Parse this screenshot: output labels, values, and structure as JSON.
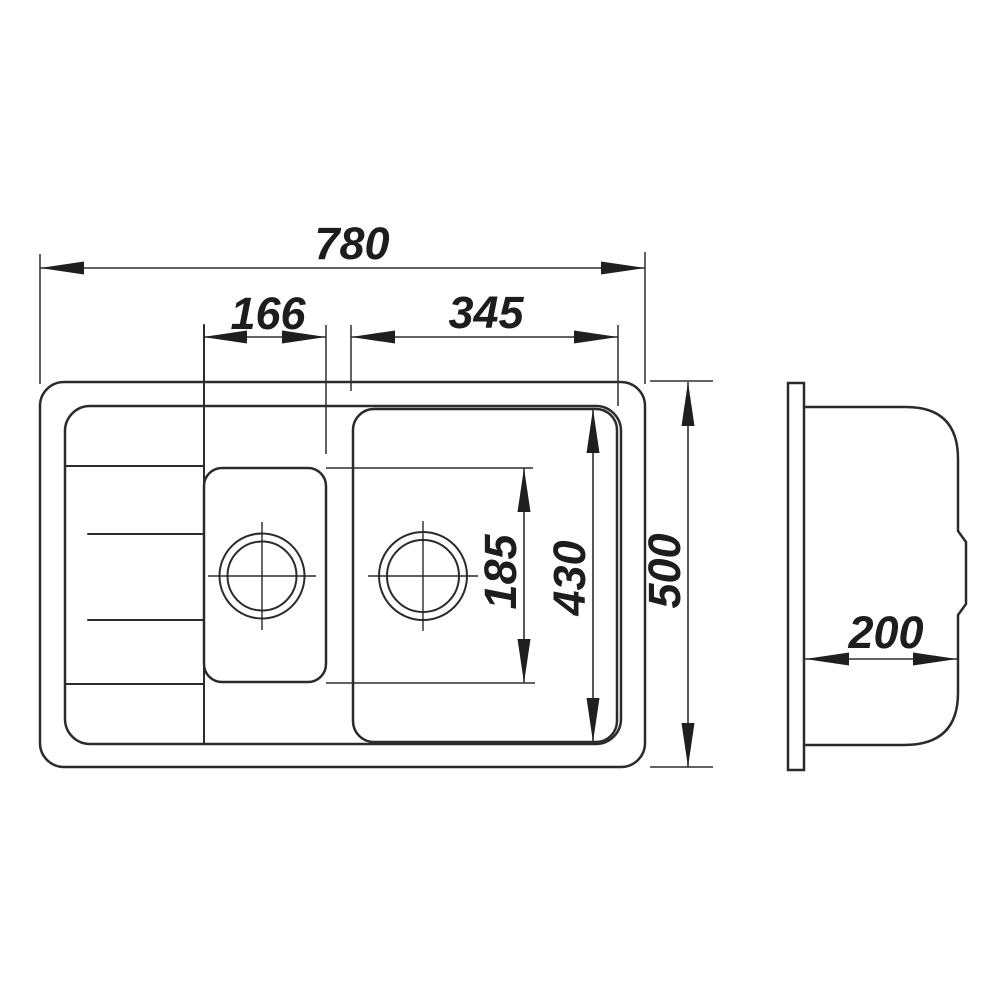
{
  "drawing": {
    "kind": "sink-technical-drawing",
    "background_color": "#ffffff",
    "line_color": "#2b2b2b",
    "dimensions": {
      "overall_width": "780",
      "small_bowl_width": "166",
      "large_bowl_width": "345",
      "small_bowl_span": "185",
      "large_bowl_span": "430",
      "overall_depth": "500",
      "side_depth": "200"
    }
  }
}
